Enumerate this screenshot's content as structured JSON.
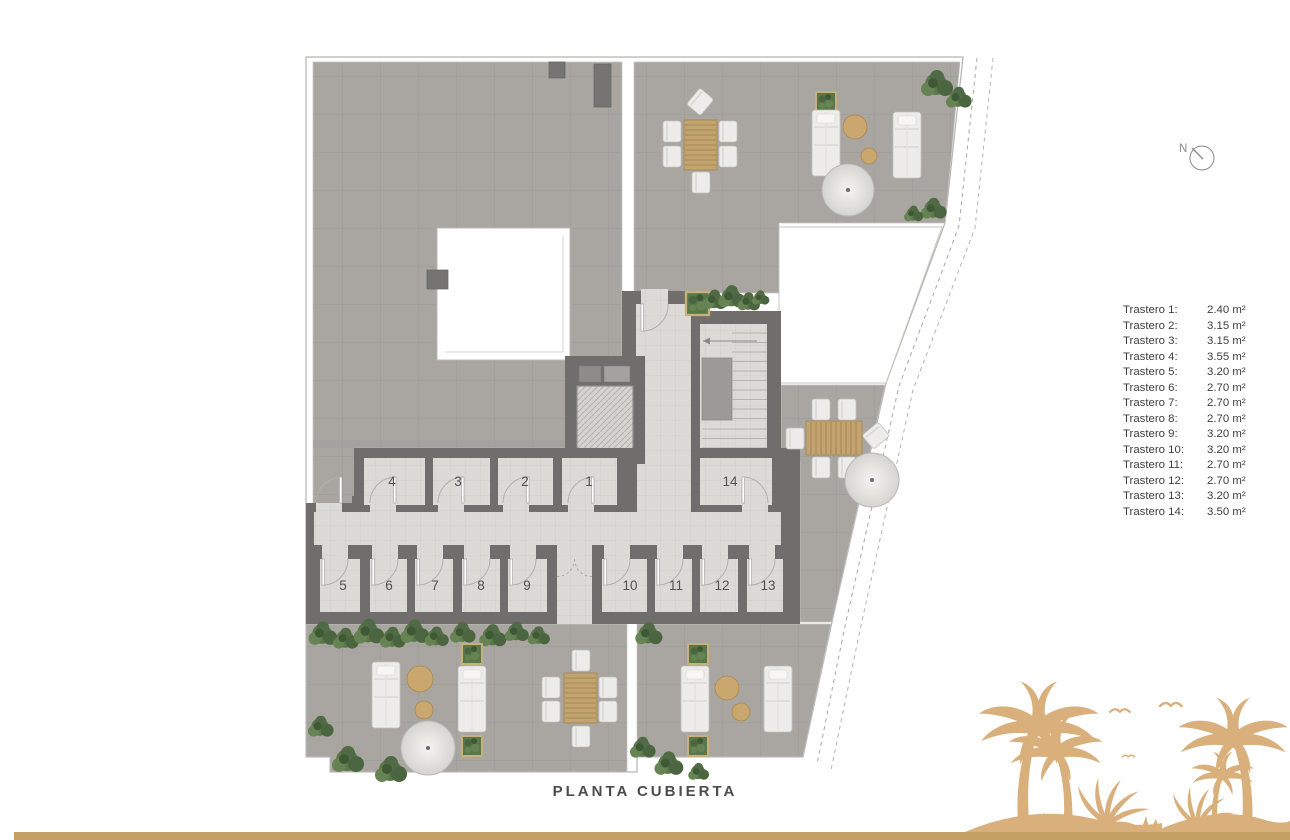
{
  "title": "PLANTA CUBIERTA",
  "compass": {
    "label": "N"
  },
  "legend": {
    "items": [
      {
        "label": "Trastero 1:",
        "value": "2.40 m²"
      },
      {
        "label": "Trastero 2:",
        "value": "3.15 m²"
      },
      {
        "label": "Trastero 3:",
        "value": "3.15 m²"
      },
      {
        "label": "Trastero 4:",
        "value": "3.55 m²"
      },
      {
        "label": "Trastero 5:",
        "value": "3.20 m²"
      },
      {
        "label": "Trastero 6:",
        "value": "2.70 m²"
      },
      {
        "label": "Trastero 7:",
        "value": "2.70 m²"
      },
      {
        "label": "Trastero 8:",
        "value": "2.70 m²"
      },
      {
        "label": "Trastero 9:",
        "value": "3.20 m²"
      },
      {
        "label": "Trastero 10:",
        "value": "3.20 m²"
      },
      {
        "label": "Trastero 11:",
        "value": "2.70 m²"
      },
      {
        "label": "Trastero 12:",
        "value": "2.70 m²"
      },
      {
        "label": "Trastero 13:",
        "value": "3.20 m²"
      },
      {
        "label": "Trastero 14:",
        "value": "3.50 m²"
      }
    ]
  },
  "plan": {
    "rooms": [
      {
        "number": "1"
      },
      {
        "number": "2"
      },
      {
        "number": "3"
      },
      {
        "number": "4"
      },
      {
        "number": "5"
      },
      {
        "number": "6"
      },
      {
        "number": "7"
      },
      {
        "number": "8"
      },
      {
        "number": "9"
      },
      {
        "number": "10"
      },
      {
        "number": "11"
      },
      {
        "number": "12"
      },
      {
        "number": "13"
      },
      {
        "number": "14"
      }
    ]
  },
  "colors": {
    "terrace_tile": "#a9a6a2",
    "interior_floor": "#dbdad7",
    "wall": "#6f6e6c",
    "legend_text": "#3e3e3e",
    "title_text": "#4c4c4c",
    "palm_silhouette": "#d9b07c",
    "footer_bar": "#c4a065"
  }
}
